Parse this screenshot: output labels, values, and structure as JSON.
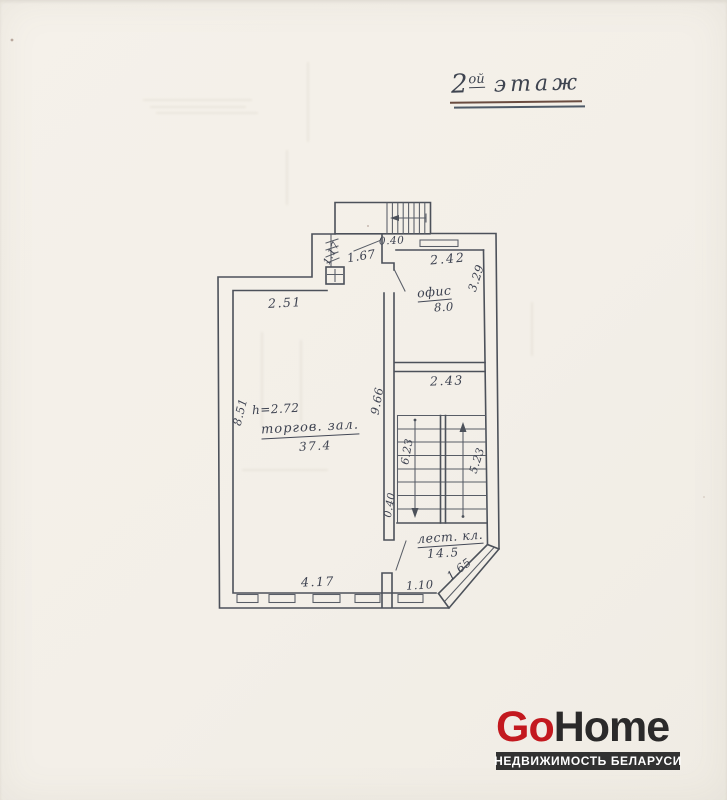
{
  "document": {
    "kind": "scanned floor plan",
    "floor_title": {
      "number": "2",
      "sup": "ой",
      "word": "этаж"
    }
  },
  "plan": {
    "dims": {
      "top_040": "0.40",
      "w_117": "1.17",
      "w_167": "1.67",
      "w_242": "2.42",
      "w_329": "3.29",
      "w_251": "2.51",
      "w_966": "9.66",
      "w_243": "2.43",
      "w_851": "8.51",
      "w_623": "6.23",
      "w_523": "5.23",
      "side_040": "0.40",
      "w_417": "4.17",
      "w_110": "1.10",
      "w_165": "1.65"
    },
    "rooms": {
      "office": {
        "name": "офис",
        "area": "8.0"
      },
      "hall": {
        "name": "торгов. зал.",
        "area": "37.4",
        "height": "h=2.72"
      },
      "stairwell": {
        "name": "лест. кл.",
        "area": "14.5"
      }
    }
  },
  "logo": {
    "brand_primary": "Go",
    "brand_secondary": "Home",
    "tagline": "НЕДВИЖИМОСТЬ БЕЛАРУСИ",
    "colors": {
      "red": "#c3191f",
      "dark": "#2b2a2a",
      "bar_bg": "#323232"
    }
  }
}
